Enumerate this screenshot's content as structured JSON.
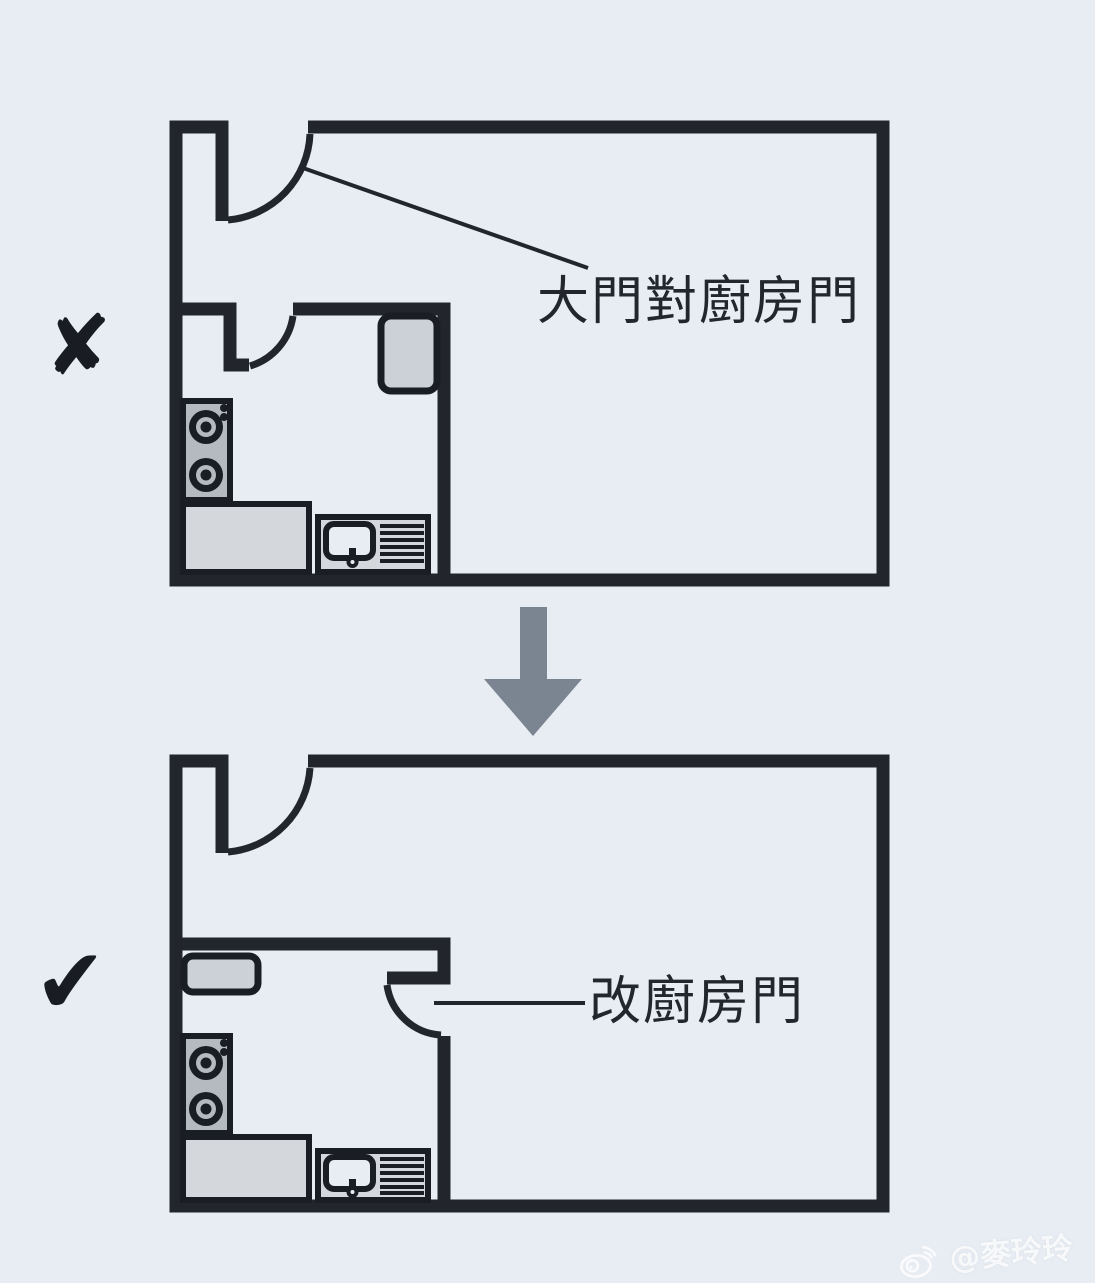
{
  "diagram": {
    "before": {
      "verdict_icon": "✘",
      "label": "大門對廚房門"
    },
    "after": {
      "verdict_icon": "✔",
      "label": "改廚房門"
    },
    "colors": {
      "background": "#e8ecf3",
      "wall": "#22262c",
      "counter_fill": "#d4d8dd",
      "appliance_fill": "#ccd1d7",
      "stove_fill": "#b5bac1",
      "arrow": "#7b8591",
      "label_text": "#23272d",
      "watermark": "#ffffff"
    }
  },
  "watermark": {
    "icon": "weibo-icon",
    "handle": "@麥玲玲"
  }
}
